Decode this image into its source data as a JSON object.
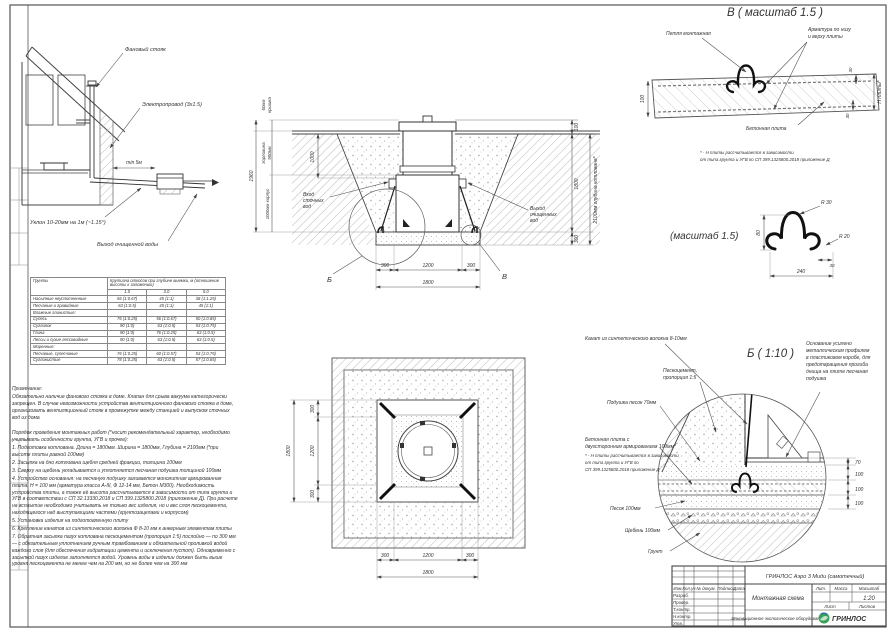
{
  "house": {
    "fan_stack": "Фановый стояк",
    "wiring": "Электропровод (3х1.5)",
    "min_dist": "min 5м",
    "slope": "Уклон 10-20мм на 1м (~1.15°)",
    "outlet": "Выход очищенной воды"
  },
  "section": {
    "dim_total": "1960",
    "dim_cover_a": "60мм",
    "dim_cover_b": "крышка",
    "dim_neck_a": "горловина",
    "dim_neck_b": "900мм",
    "dim_body": "1000мм корпус",
    "dim_1000": "1000",
    "dim_100": "100",
    "dim_1800": "1800",
    "dim_300": "300",
    "dim_depth": "2100мм глубина котлована*",
    "dim_b300l": "300",
    "dim_b1200": "1200",
    "dim_b300r": "300",
    "dim_b1800": "1800",
    "inlet": [
      "Вход",
      "сточных",
      "вод"
    ],
    "outlet": [
      "Выход",
      "очищенных",
      "вод"
    ],
    "callout_b": "Б",
    "callout_v": "В"
  },
  "plan": {
    "dim_l1800": "1800",
    "dim_l300t": "300",
    "dim_l1200": "1200",
    "dim_l300b": "300",
    "dim_b300l": "300",
    "dim_b1200": "1200",
    "dim_b300r": "300",
    "dim_b1800": "1800"
  },
  "detail_v": {
    "title": "В ( масштаб 1.5 )",
    "loop_label": "Петля монтажная",
    "rebar": [
      "Арматура по низу",
      "и верху плиты"
    ],
    "slab_label": "Бетонная плита",
    "dim_100": "100",
    "dim_30a": "30",
    "dim_30b": "30",
    "dim_h": "Н плиты*",
    "note": [
      "* - Н плиты рассчитывается в зависимости",
      "от типа грунта и УГВ по СП 399.1325800.2018 приложение Д"
    ]
  },
  "detail_loop": {
    "title": "(масштаб 1.5)",
    "r30": "R 30",
    "r20": "R 20",
    "dim_80": "80",
    "dim_30": "30",
    "dim_240": "240"
  },
  "detail_b": {
    "title": "Б ( 1:10 )",
    "rope": "Канат из синтетического волокна 8-10мм",
    "sandcement": [
      "Пескоцемент,",
      "пропорция 1:5"
    ],
    "cushion": "Подушка песок 70мм",
    "slab_label": [
      "Бетонная плита с",
      "двухсторонним армированием 100мм*"
    ],
    "slab_note": [
      "* - Н плиты рассчитывается в зависимости",
      "от типа грунта и УГВ по",
      "СП 399.1325800.2018 приложение Д"
    ],
    "sand": "Песок 100мм",
    "gravel": "Щебень 100мм",
    "soil": "Грунт",
    "base_note": [
      "Основание усилено",
      "металлическим профилем",
      "в пластиковом коробе, для",
      "предотвращения прогиба",
      "днища на плите песчаная",
      "подушка"
    ],
    "dim_70": "70",
    "dim_100a": "100",
    "dim_100b": "100",
    "dim_100c": "100"
  },
  "table": {
    "col_soil": "Грунты",
    "col_slope": "Крутизна откосов при глубине выемки, м (отношение высоты к заложению)",
    "d1": "1.5",
    "d2": "3.0",
    "d3": "5.0",
    "rows": [
      {
        "n": "Насыпные неуплотненные",
        "c1": "56 (1:0.67)",
        "c2": "45 (1:1)",
        "c3": "38 (1:1.25)"
      },
      {
        "n": "Песчаные и гравийные",
        "c1": "63 (1:0.5)",
        "c2": "45 (1:1)",
        "c3": "45 (1:1)"
      },
      {
        "n": "Влажные глинистые:",
        "c1": "",
        "c2": "",
        "c3": ""
      },
      {
        "n": "Супесь",
        "c1": "76 (1:0.25)",
        "c2": "56 (1:0.67)",
        "c3": "50 (1:0.85)"
      },
      {
        "n": "Суглинок",
        "c1": "90 (1:0)",
        "c2": "63 (1:0.5)",
        "c3": "53 (1:0.75)"
      },
      {
        "n": "Глина",
        "c1": "90 (1:0)",
        "c2": "76 (1:0.25)",
        "c3": "63 (1:0.5)"
      },
      {
        "n": "Лессы и сухие лессовидные",
        "c1": "90 (1:0)",
        "c2": "63 (1:0.5)",
        "c3": "63 (1:0.5)"
      },
      {
        "n": "Моренные:",
        "c1": "",
        "c2": "",
        "c3": ""
      },
      {
        "n": "Песчаные, супесчаные",
        "c1": "76 (1:0.25)",
        "c2": "60 (1:0.57)",
        "c3": "53 (1:0.75)"
      },
      {
        "n": "Суглинистые",
        "c1": "78 (1:0.25)",
        "c2": "63 (1:0.5)",
        "c3": "57 (1:0.65)"
      }
    ]
  },
  "notes": {
    "title": "Примечание:",
    "para1": "Обязательно наличие фанового стояка в доме. Клапан для срыва вакуума категорически запрещен. В случае невозможности устройства вентиляционного фанового стояка в доме, организовать вентиляционный стояк в промежутке между станцией и выпуском сточных вод из дома",
    "para2": "Порядок проведения монтажных работ (*носит рекомендательный характер, необходимо учитывать особенности грунта, УГВ и прочее):",
    "items": [
      "1. Подготовка котлована. Длина = 1800мм.  Ширина = 1800мм, Глубина = 2100мм (*при высоте плиты равной 100мм)",
      "2. Засыпка на дно котлована щебня средней фракции, толщина 100мм",
      "3. Сверху на щебень укладывается и уплотняется песчаная подушка толщиной 100мм",
      "4. Устройство основания: на песчаную подушку заливается монолитная армированная плита, Н = 100 мм (арматура класса А-III, Ф 12-14 мм, Бетон М300). Необходимость устройства плиты, а также её высота рассчитывается в зависимости от типа грунта и УГВ в соответствии с СП 32.13330.2018 и СП 399.1325800.2018 (приложение Д). При расчете на всплытие необходимо учитывать не только вес изделия, но и вес слоя пескоцемента, находящегося над выступающими частями (грунтозацепами и корпусом)",
      "5. Установка изделия на подготовленную плиту",
      "6. Крепление канатов из синтетического волокна Ф 8-10 мм к анкерным элементам плиты",
      "7. Обратная засыпка пазух котлована пескоцементом (пропорция 1:5) послойно — по 300 мм — с обязательным уплотнением ручным трамбованием и обязательной проливкой водой каждого слоя (для обеспечения гидратации цемента и исключения пустот). Одновременно с засыпкой пазух изделие заполняется водой. Уровень воды в изделии должен быть выше уровня пескоцемента не менее чем на 200 мм, но не более чем на 300 мм"
    ]
  },
  "titleblock": {
    "product": "ГРИНЛОС Аэро 3 Миди (самотечный)",
    "doc_name": "Монтажная схема",
    "scale_value": "1:20",
    "lit_label": "Лит.",
    "mass_label": "Масса",
    "scale_label": "Масштаб",
    "sheet_label": "Лист",
    "sheets_label": "Листов",
    "h1": "Изм.",
    "h2": "Кол.уч",
    "h3": "№ докум.",
    "h4": "Подпись",
    "h5": "Дата",
    "r1": "Разраб.",
    "r2": "Провер.",
    "r3": "Т.контр.",
    "r4": "Н.контр.",
    "r5": "Утв.",
    "slogan": "Инновационное экологическое оборудование",
    "brand": "ГРИНЛОС"
  }
}
